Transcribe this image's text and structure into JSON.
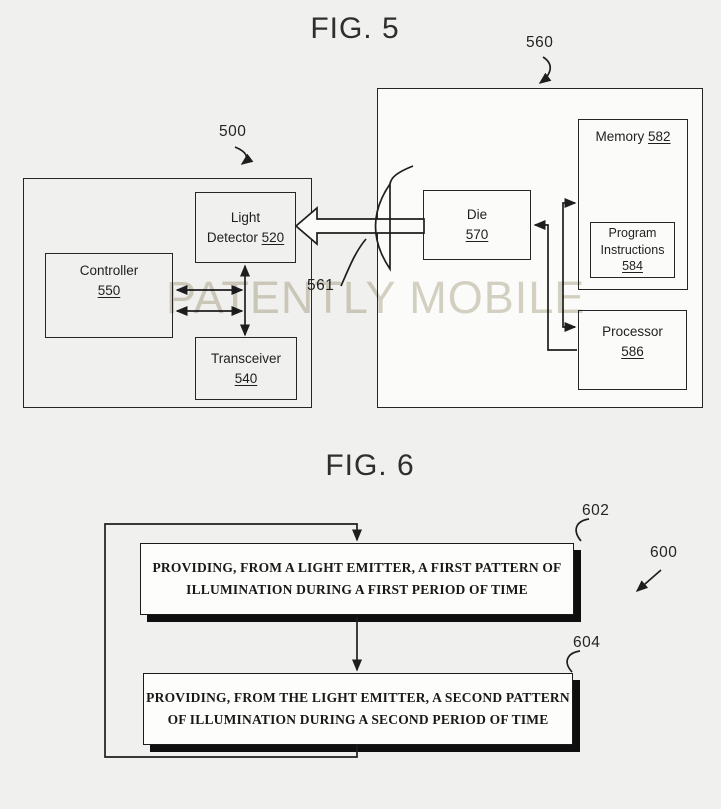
{
  "figure5": {
    "title": "FIG. 5",
    "watermark": "PATENTLY MOBILE",
    "refs": {
      "system": "500",
      "remote_device": "560",
      "lens": "575",
      "light": "561"
    },
    "boxes": {
      "light_detector": {
        "lines": [
          "Light",
          "Detector"
        ],
        "ref": "520"
      },
      "controller": {
        "lines": [
          "Controller"
        ],
        "ref": "550"
      },
      "transceiver": {
        "lines": [
          "Transceiver"
        ],
        "ref": "540"
      },
      "die": {
        "lines": [
          "Die"
        ],
        "ref": "570"
      },
      "memory": {
        "lines": [
          "Memory"
        ],
        "ref": "582"
      },
      "program_instructions": {
        "lines": [
          "Program",
          "Instructions"
        ],
        "ref": "584"
      },
      "processor": {
        "lines": [
          "Processor"
        ],
        "ref": "586"
      }
    }
  },
  "figure6": {
    "title": "FIG. 6",
    "refs": {
      "method": "600",
      "step_1": "602",
      "step_2": "604"
    },
    "steps": {
      "step_1": {
        "lines": [
          "PROVIDING, FROM A LIGHT EMITTER, A FIRST PATTERN OF",
          "ILLUMINATION DURING A FIRST PERIOD OF TIME"
        ]
      },
      "step_2": {
        "lines": [
          "PROVIDING, FROM THE LIGHT EMITTER, A SECOND PATTERN",
          "OF ILLUMINATION DURING A SECOND PERIOD OF TIME"
        ]
      }
    }
  },
  "colors": {
    "background": "#f0f0ef",
    "panel_white": "#fbfbfa",
    "line": "#1e1e1e",
    "shadow": "#0f0f0f",
    "watermark": "#d8d4c5"
  }
}
